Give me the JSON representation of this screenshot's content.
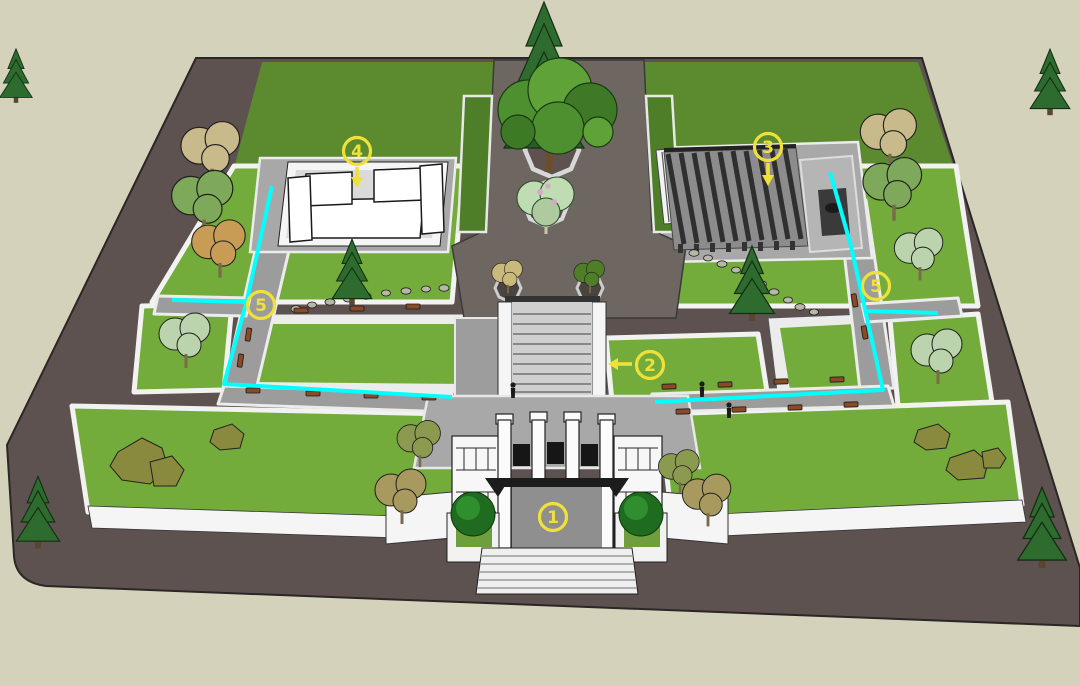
{
  "scene_colors": {
    "sky": "#D5D2BC",
    "ground": "#5D5250",
    "lawn": "#74AC3C",
    "lawn_dark": "#5C8A2E",
    "path_gray": "#9C9C9C",
    "axis_pavement": "#6E6660",
    "wall_white": "#F5F5F5",
    "route_highlight": "#00FFFF",
    "marker_yellow": "#EFE139",
    "bench_brown": "#8B4A26",
    "conifer_green": "#2E6B2E",
    "tree_green": "#4E8F2F",
    "tree_tan": "#C9BA8C",
    "tree_light": "#BFDCB2",
    "shrub_olive": "#8A8A3E"
  },
  "markers": [
    {
      "name": "marker-1-entrance-gate",
      "number": "1",
      "transform": "translate(553,517)",
      "arrow": "none"
    },
    {
      "name": "marker-2-central-steps",
      "number": "2",
      "transform": "translate(650,365)",
      "arrow": "left"
    },
    {
      "name": "marker-3-pergola",
      "number": "3",
      "transform": "translate(768,147)",
      "arrow": "down"
    },
    {
      "name": "marker-4-pavilion",
      "number": "4",
      "transform": "translate(357,151)",
      "arrow": "down"
    },
    {
      "name": "marker-5-west-junction",
      "number": "5",
      "transform": "translate(261,305)",
      "arrow": "none"
    },
    {
      "name": "marker-5-east-junction",
      "number": "5",
      "transform": "translate(876,286)",
      "arrow": "none"
    }
  ],
  "routes": {
    "west_main": "272,186 247,300 224,384 452,397",
    "west_spur": "172,300 248,302",
    "east_main": "830,172 851,246 883,390 655,402",
    "east_spur": "864,311 938,313"
  }
}
